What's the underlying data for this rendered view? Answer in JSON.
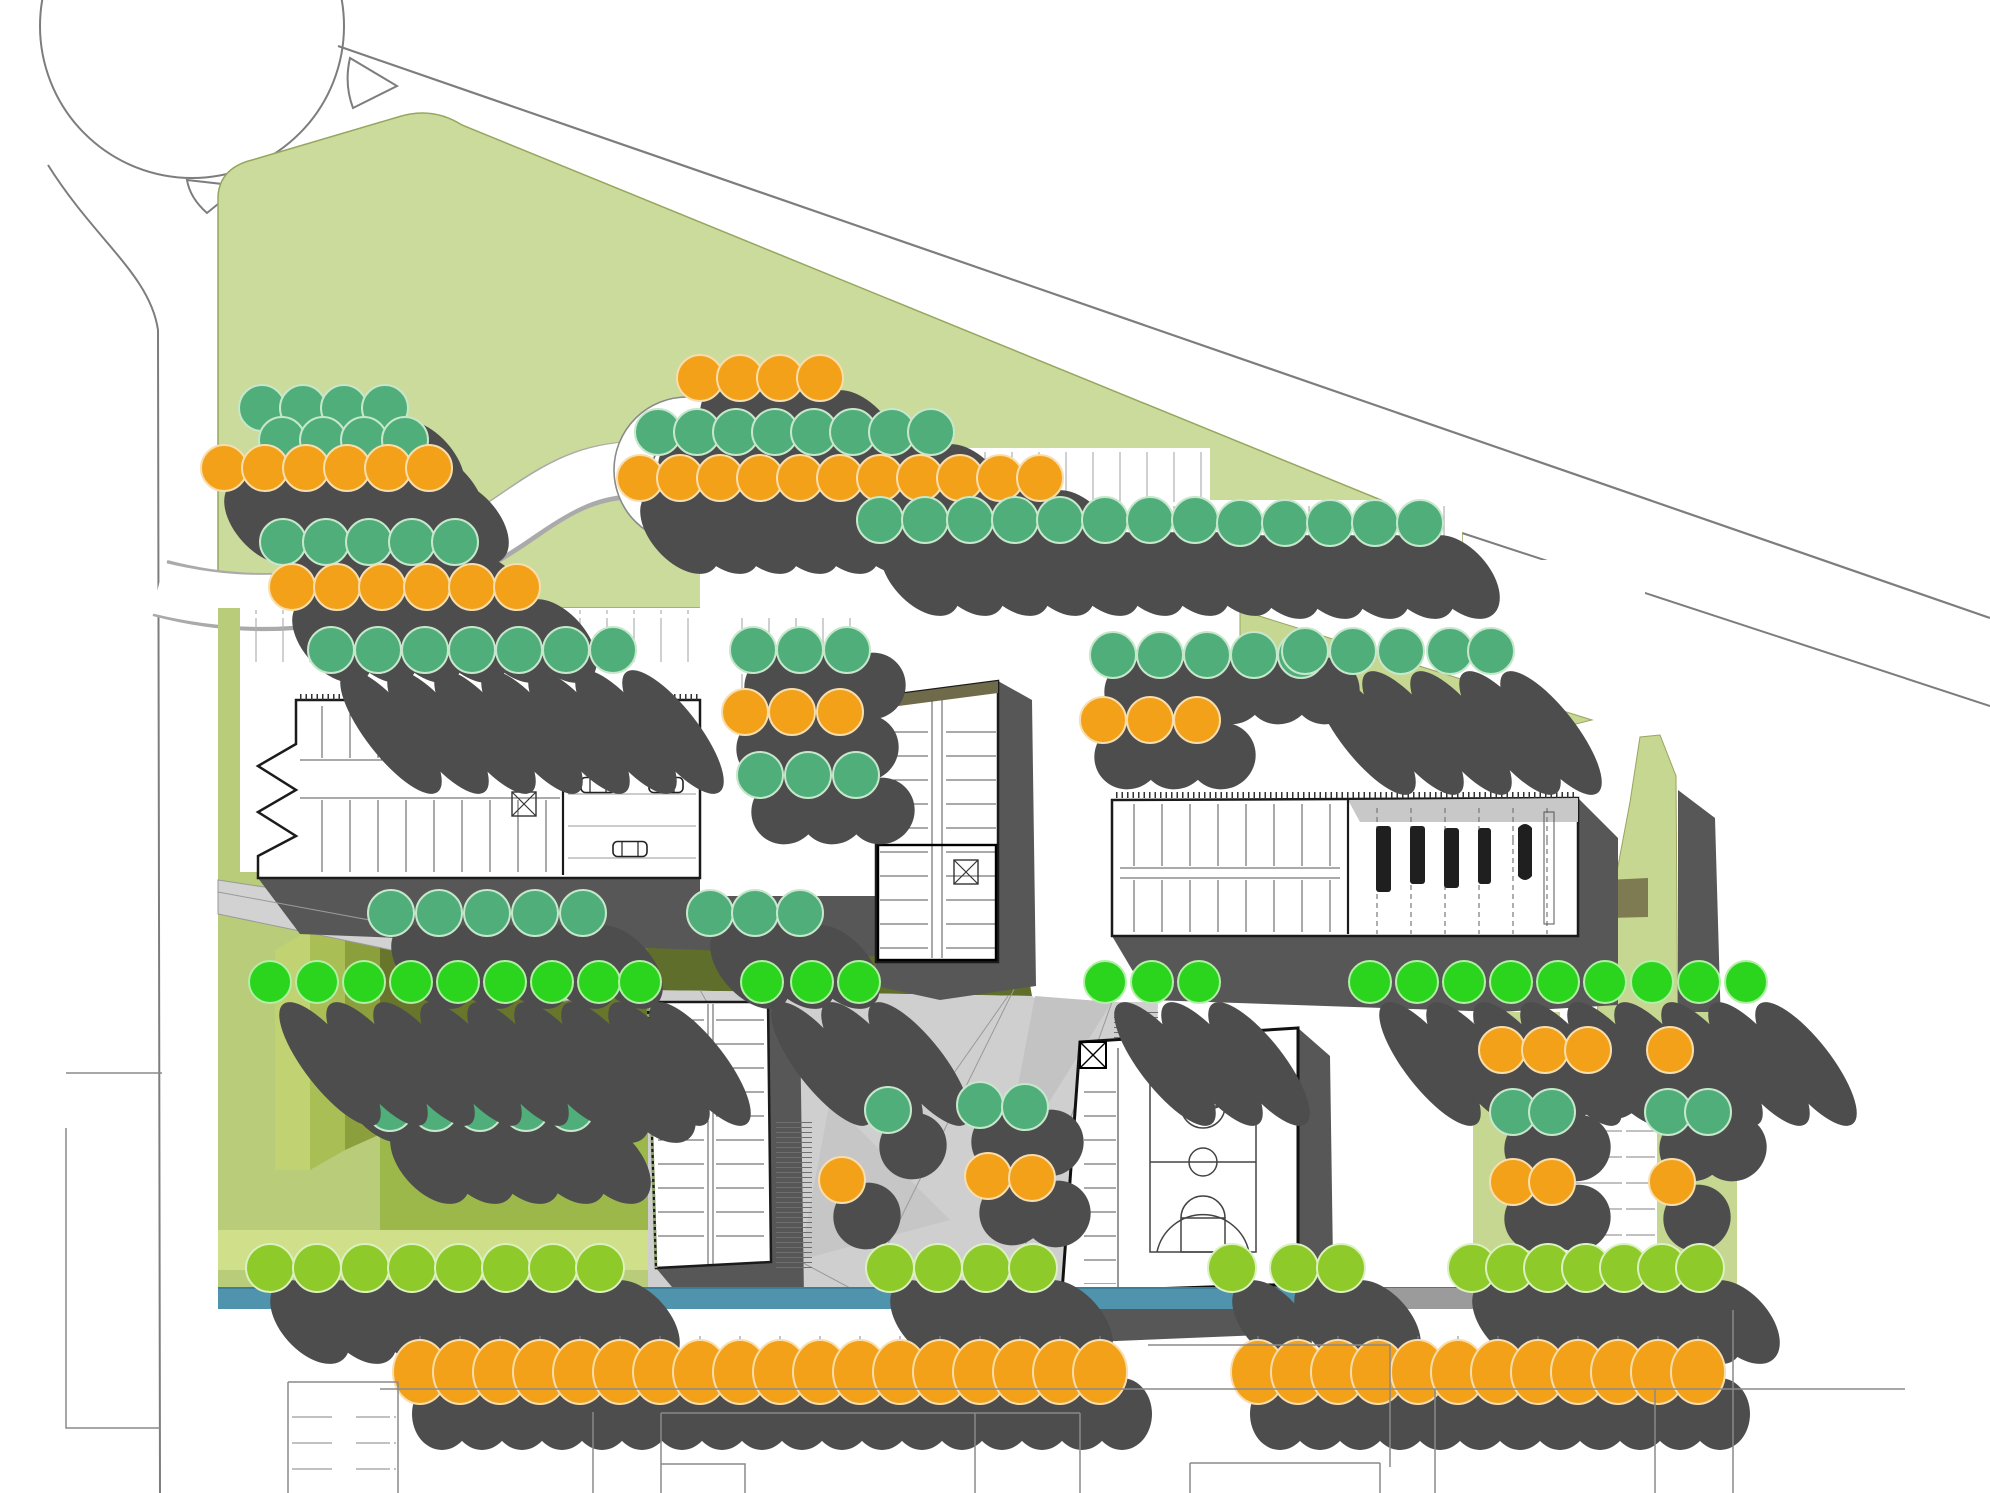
{
  "helipad": {
    "label": "H"
  },
  "colors": {
    "park_green": "#cbdb9b",
    "lawn_green": "#b9cc79",
    "olive_dark": "#68762c",
    "olive_band": "#5f6e2a",
    "terrace_1": "#8ba03c",
    "terrace_2": "#a9bf55",
    "terrace_3": "#c0d272",
    "meadow_mid": "#9cb84b",
    "meadow_pale": "#cfdf8a",
    "plaza_gray": "#cfcfcf",
    "water_teal": "#4f93ad",
    "shadow_dark": "#4d4d4d",
    "building_shadow": "#575757",
    "tree_orange": "#f2a119",
    "tree_sea_green": "#4fae79",
    "tree_lime": "#8ecb2a",
    "tree_vivid_green": "#2bd51d",
    "road_line": "#7d7d7d",
    "wall_black": "#1b1b1b",
    "roof_olive": "#6f6b4a"
  },
  "site": {
    "tree_groups": [
      {
        "c": "sea",
        "s": "mid",
        "y": 408,
        "xs": [
          262,
          303,
          344,
          385
        ]
      },
      {
        "c": "sea",
        "s": "mid",
        "y": 440,
        "xs": [
          282,
          323,
          364,
          405
        ]
      },
      {
        "c": "orange",
        "s": "mid",
        "y": 468,
        "xs": [
          224,
          265,
          306,
          347,
          388,
          429
        ]
      },
      {
        "c": "sea",
        "s": "mid",
        "y": 542,
        "xs": [
          283,
          326,
          369,
          412,
          455
        ]
      },
      {
        "c": "orange",
        "s": "mid",
        "y": 587,
        "xs": [
          292,
          337,
          382,
          427,
          472,
          517
        ]
      },
      {
        "c": "sea",
        "s": "long",
        "y": 650,
        "xs": [
          331,
          378,
          425,
          472,
          519,
          566,
          613
        ]
      },
      {
        "c": "orange",
        "s": "mid",
        "y": 378,
        "xs": [
          700,
          740,
          780,
          820
        ]
      },
      {
        "c": "sea",
        "s": "mid",
        "y": 432,
        "xs": [
          658,
          697,
          736,
          775,
          814,
          853,
          892,
          931
        ]
      },
      {
        "c": "orange",
        "s": "mid",
        "y": 478,
        "xs": [
          640,
          680,
          720,
          760,
          800,
          840,
          880,
          920,
          960,
          1000,
          1040
        ]
      },
      {
        "c": "sea",
        "s": "mid",
        "y": 520,
        "xs": [
          880,
          925,
          970,
          1015,
          1060,
          1105,
          1150,
          1195
        ]
      },
      {
        "c": "sea",
        "s": "mid",
        "y": 523,
        "xs": [
          1240,
          1285,
          1330,
          1375,
          1420
        ]
      },
      {
        "c": "sea",
        "s": "round",
        "y": 650,
        "xs": [
          753,
          800,
          847
        ]
      },
      {
        "c": "orange",
        "s": "round",
        "y": 712,
        "xs": [
          745,
          792,
          840
        ]
      },
      {
        "c": "sea",
        "s": "round",
        "y": 775,
        "xs": [
          760,
          808,
          856
        ]
      },
      {
        "c": "sea",
        "s": "round",
        "y": 655,
        "xs": [
          1113,
          1160,
          1207,
          1254,
          1301
        ]
      },
      {
        "c": "orange",
        "s": "round",
        "y": 720,
        "xs": [
          1103,
          1150,
          1197
        ]
      },
      {
        "c": "sea",
        "s": "long",
        "y": 651,
        "xs": [
          1305,
          1353,
          1401,
          1450,
          1491
        ]
      },
      {
        "c": "sea",
        "s": "mid",
        "y": 913,
        "xs": [
          391,
          439,
          487,
          535,
          583,
          710,
          755,
          800
        ]
      },
      {
        "c": "orange",
        "s": "mid",
        "y": 1047,
        "xs": [
          340,
          386,
          432,
          478,
          524,
          570,
          616
        ]
      },
      {
        "c": "sea",
        "s": "mid",
        "y": 1108,
        "xs": [
          390,
          435,
          480,
          526,
          571
        ]
      },
      {
        "c": "vivid",
        "s": "long",
        "r": 21,
        "y": 982,
        "xs": [
          270,
          317,
          364,
          411,
          458,
          505,
          552,
          599,
          640,
          762,
          812,
          859,
          1105,
          1152,
          1199,
          1370,
          1417,
          1464,
          1511,
          1558,
          1605,
          1652,
          1699,
          1746
        ]
      },
      {
        "c": "sea",
        "s": "round",
        "pts": [
          [
            888,
            1110
          ],
          [
            980,
            1105
          ],
          [
            1025,
            1107
          ]
        ]
      },
      {
        "c": "orange",
        "s": "round",
        "pts": [
          [
            842,
            1180
          ],
          [
            988,
            1176
          ],
          [
            1032,
            1178
          ]
        ]
      },
      {
        "c": "orange",
        "s": "round",
        "y": 1050,
        "xs": [
          1502,
          1545,
          1588,
          1670
        ]
      },
      {
        "c": "sea",
        "s": "round",
        "y": 1112,
        "xs": [
          1513,
          1552,
          1668,
          1708
        ]
      },
      {
        "c": "orange",
        "s": "round",
        "y": 1182,
        "xs": [
          1513,
          1552,
          1672
        ]
      },
      {
        "c": "lime",
        "s": "mid",
        "r": 24,
        "y": 1268,
        "xs": [
          270,
          317,
          365,
          412,
          459,
          506,
          553,
          600,
          890,
          938,
          986,
          1033,
          1232,
          1294,
          1341,
          1472,
          1510,
          1548,
          1586,
          1624,
          1662,
          1700
        ]
      },
      {
        "c": "orange",
        "s": "bottom",
        "ell": true,
        "y": 1372,
        "xs": [
          420,
          460,
          500,
          540,
          580,
          620,
          660,
          700,
          740,
          780,
          820,
          860,
          900,
          940,
          980,
          1020,
          1060,
          1100
        ]
      },
      {
        "c": "orange",
        "s": "bottom",
        "ell": true,
        "y": 1372,
        "xs": [
          1258,
          1298,
          1338,
          1378,
          1418,
          1458,
          1498,
          1538,
          1578,
          1618,
          1658,
          1698
        ]
      }
    ]
  }
}
